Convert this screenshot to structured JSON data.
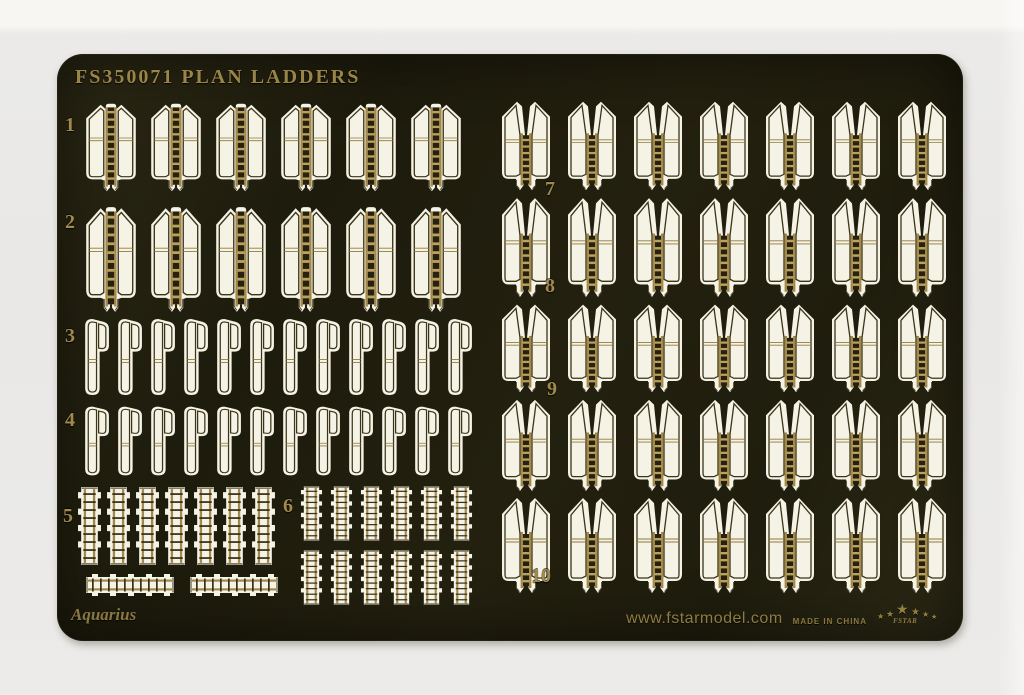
{
  "page": {
    "background_color": "#ecebe9"
  },
  "sheet": {
    "title": "FS350071 PLAN LADDERS",
    "brand_script": "Aquarius",
    "footer": {
      "website": "www.fstarmodel.com",
      "made_in": "MADE IN CHINA",
      "logo_text": "FSTAR",
      "star_glyph": "★"
    },
    "colors": {
      "fret_dark": "#211f0e",
      "etch_white": "#f5f2e6",
      "brass": "#a2894a",
      "gold_text": "#9a8547"
    },
    "rows": [
      {
        "label": "1",
        "type": "ladder-folded",
        "count": 6
      },
      {
        "label": "2",
        "type": "ladder-folded",
        "count": 6
      },
      {
        "label": "3",
        "type": "side-rail",
        "count": 12
      },
      {
        "label": "4",
        "type": "side-rail",
        "count": 12
      },
      {
        "label": "5",
        "type": "ladder-strip-vertical",
        "count": 7
      },
      {
        "label": "",
        "type": "ladder-strip-horizontal",
        "count": 2
      },
      {
        "label": "6",
        "type": "ladder-strip-vertical",
        "count": 12
      },
      {
        "label": "7",
        "type": "ladder-folded-wide",
        "count": 7
      },
      {
        "label": "8",
        "type": "ladder-folded-wide",
        "count": 7
      },
      {
        "label": "9",
        "type": "ladder-folded-wide",
        "count": 7
      },
      {
        "label": "",
        "type": "ladder-folded-wide",
        "count": 7
      },
      {
        "label": "10",
        "type": "ladder-folded-wide",
        "count": 7
      }
    ]
  }
}
